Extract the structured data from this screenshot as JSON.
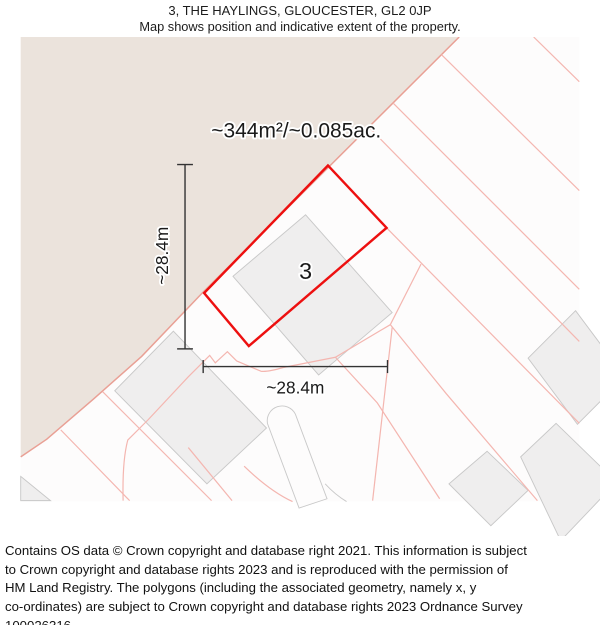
{
  "header": {
    "title": "3, THE HAYLINGS, GLOUCESTER, GL2 0JP",
    "subtitle": "Map shows position and indicative extent of the property."
  },
  "map": {
    "area_label": "~344m²/~0.085ac.",
    "plot_label": "3",
    "width_label": "~28.4m",
    "height_label": "~28.4m",
    "property_polygon_points": "330,175 393,242 245,369 197,312",
    "colors": {
      "property_outline": "#ed1010",
      "parcel_line": "#f4b6b0",
      "terrain_fill": "#ebe3dc",
      "terrain_edge": "#e9a095",
      "building_fill": "#efeeee",
      "building_edge": "#c8c8c8",
      "dimension_line": "#333333"
    }
  },
  "footer": {
    "copyright": "Contains OS data © Crown copyright and database right 2021. This information is subject\nto Crown copyright and database rights 2023 and is reproduced with the permission of\nHM Land Registry. The polygons (including the associated geometry, namely x, y\nco-ordinates) are subject to Crown copyright and database rights 2023 Ordnance Survey\n100026316."
  }
}
